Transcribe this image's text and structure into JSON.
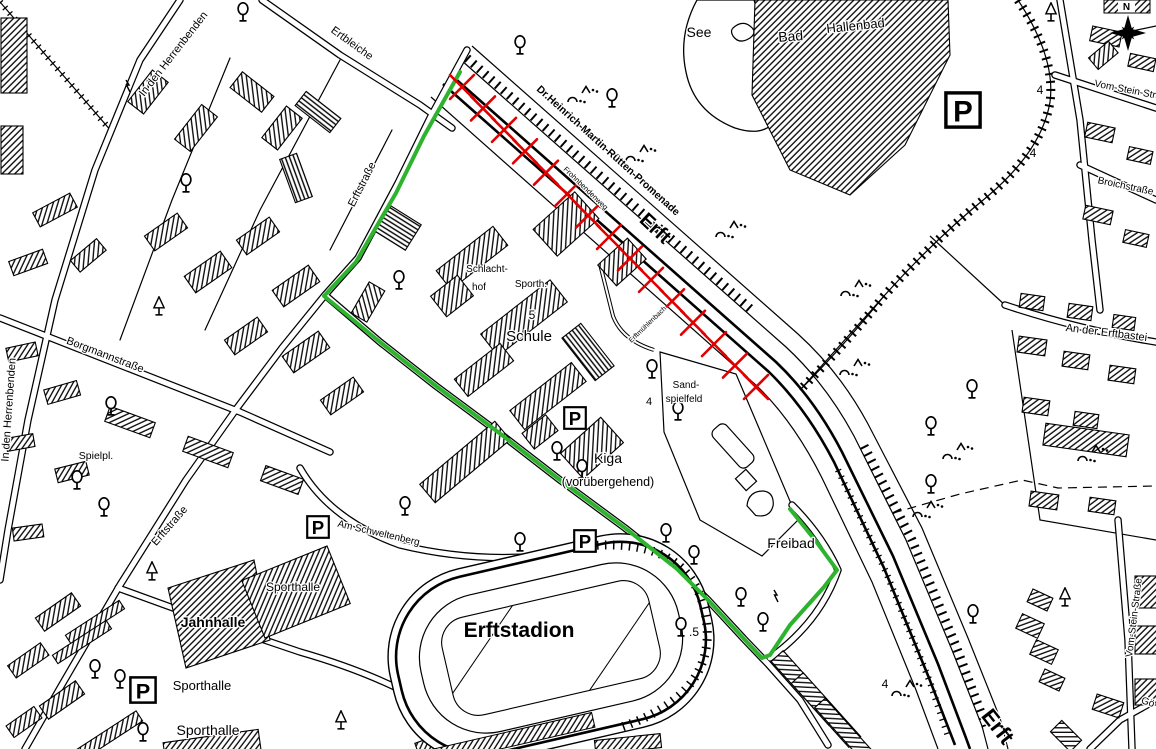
{
  "labels": {
    "in_den_herrenbenden_1": "In den Herrenbenden",
    "in_den_herrenbenden_2": "In den Herrenbenden",
    "ertbleiche": "Ertbleiche",
    "erftstrasse_1": "Erftstraße",
    "erftstrasse_2": "Erftstraße",
    "borgmannstrasse": "Borgmannstraße",
    "spielplatz": "Spielpl.",
    "schlachthof_1": "Schlacht-",
    "schlachthof_2": "hof",
    "sporthalle_abbr": "Sporth.",
    "schule_nr": "5",
    "schule": "Schule",
    "kiga": "Kiga",
    "kiga_sub": "(vorübergehend)",
    "sandspielfeld_1": "Sand-",
    "sandspielfeld_2": "spielfeld",
    "sandspielfeld_nr": "4",
    "see": "See",
    "bad": "Bad",
    "hallenbad": "Hallenbad",
    "promenade": "Dr.Heinrich-Martin-Rütten-Promenade",
    "erft_river_1": "Erft",
    "erft_river_2": "Erft",
    "frohnbendenweg": "Frohnbendenweg",
    "erftmuehlenbach": "Erftmühlenbach",
    "freibad": "Freibad",
    "erftstadion": "Erftstadion",
    "stadion_nr": ".5",
    "jahnhalle": "Jahnhalle",
    "sporthalle_1": "Sporthalle",
    "sporthalle_2": "Sporthalle",
    "sporthalle_3": "Sporthalle",
    "am_schweltenberg": "Am Schweltenberg",
    "an_der_erftbastei": "An der Erftbastei",
    "broichstrasse": "Broichstraße",
    "vom_stein_strasse_1": "Vom-Stein-Straße",
    "vom_stein_strasse_2": "Vom-Stein-Straße",
    "goestrasse_partial": "Gö",
    "nr4_a": "4",
    "nr4_b": "4",
    "nr4_c": "4"
  },
  "symbols": {
    "parking_letter": "P",
    "north_letter": "N",
    "tree_icon": "deciduous-tree",
    "fir_icon": "conifer-tree",
    "monument_icon": "bench-monument-marks",
    "bolt_icon": "power-line-flash"
  },
  "colors": {
    "route_green": "#2db32d",
    "closure_red": "#e00000",
    "map_ink": "#000000",
    "background": "#ffffff"
  },
  "overlays": {
    "green_route": {
      "points": [
        [
          460,
          72
        ],
        [
          424,
          136
        ],
        [
          396,
          193
        ],
        [
          356,
          262
        ],
        [
          324,
          296
        ],
        [
          380,
          342
        ],
        [
          436,
          386
        ],
        [
          498,
          432
        ],
        [
          560,
          480
        ],
        [
          625,
          528
        ],
        [
          676,
          568
        ],
        [
          708,
          600
        ],
        [
          745,
          640
        ],
        [
          762,
          658
        ],
        [
          770,
          655
        ],
        [
          790,
          625
        ],
        [
          824,
          587
        ],
        [
          837,
          570
        ],
        [
          815,
          540
        ],
        [
          790,
          509
        ]
      ]
    },
    "red_closure": {
      "start": [
        462,
        87
      ],
      "end": [
        756,
        387
      ],
      "count": 15,
      "size": 12
    }
  }
}
